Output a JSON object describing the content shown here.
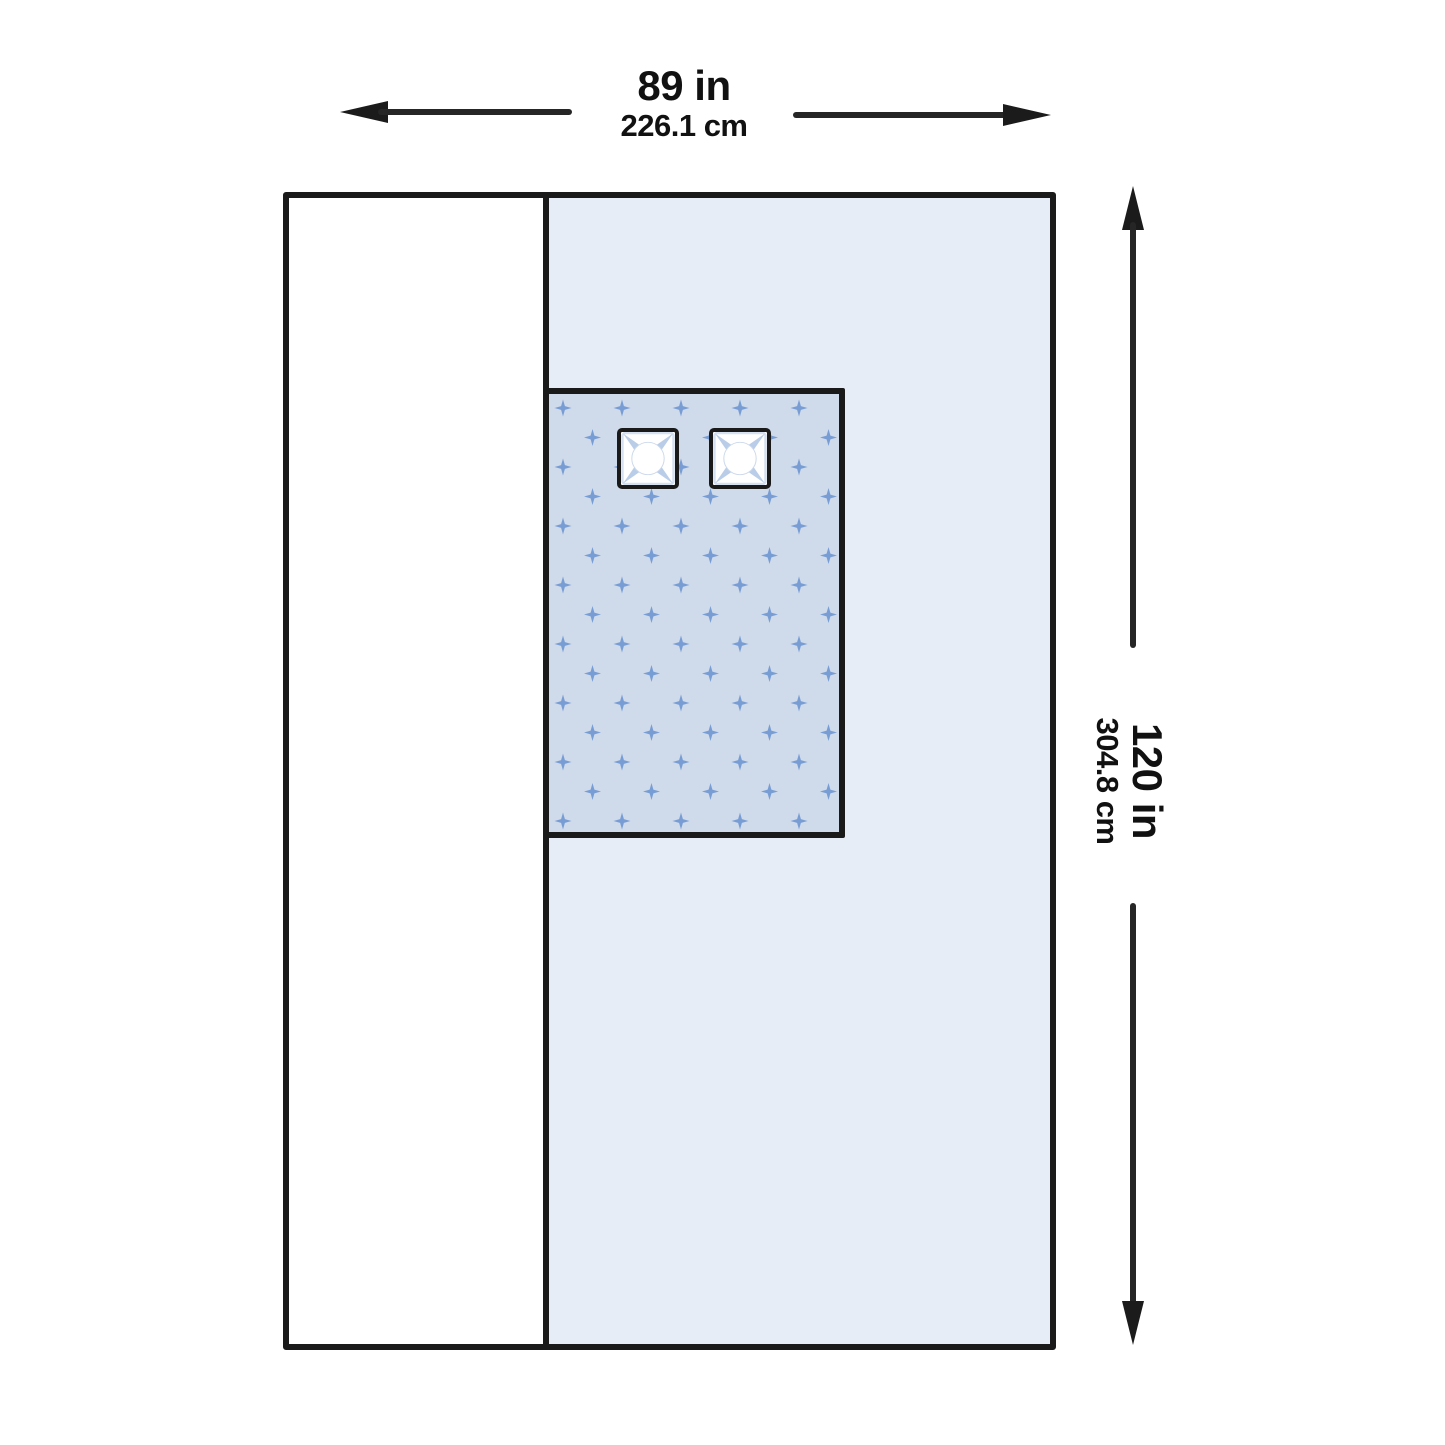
{
  "diagram": {
    "kind": "drape-dimension-diagram",
    "dimensions": {
      "width_in": "89 in",
      "width_cm": "226.1 cm",
      "height_in": "120 in",
      "height_cm": "304.8 cm"
    },
    "colors": {
      "outline": "#1a1a1a",
      "side_panel": "#ffffff",
      "main_panel": "#e7edf6",
      "fenestration_background": "#cfdaeb",
      "pattern_cross": "#6f97d2",
      "port_accent": "#b9cde8"
    },
    "icons": {
      "arrow_left": "arrow-left-icon",
      "arrow_right": "arrow-right-icon",
      "arrow_up": "arrow-up-icon",
      "arrow_down": "arrow-down-icon",
      "port_star": "port-star-icon",
      "cross_pattern": "cross-pattern"
    }
  }
}
